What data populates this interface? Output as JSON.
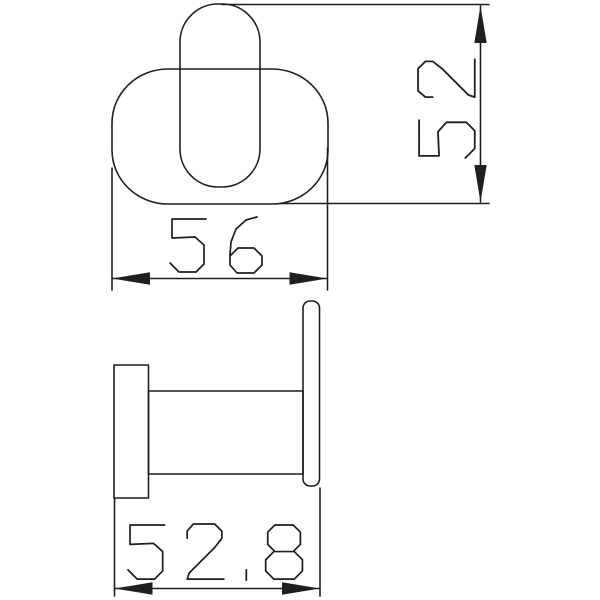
{
  "drawing": {
    "background_color": "#ffffff",
    "line_color": "#1f1f1f",
    "dimensions": {
      "width": {
        "label": "56"
      },
      "height": {
        "label": "52"
      },
      "depth": {
        "label": "52.8"
      }
    }
  }
}
